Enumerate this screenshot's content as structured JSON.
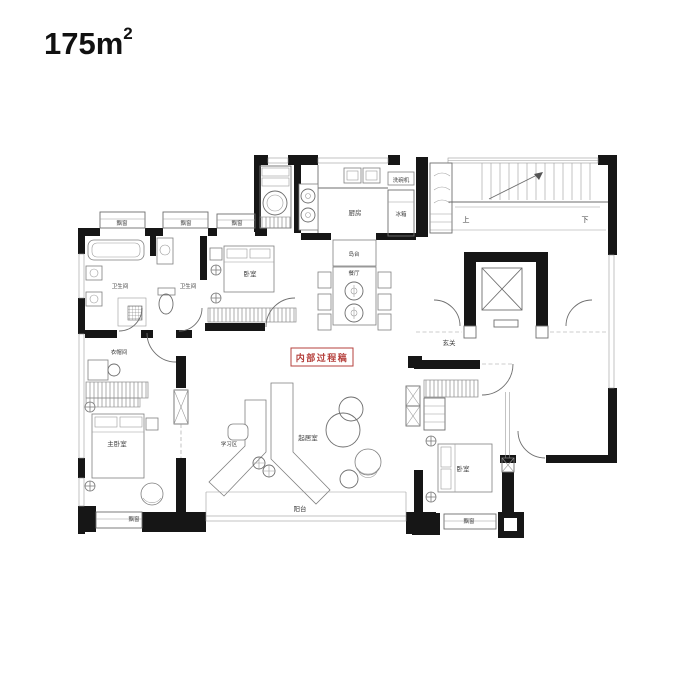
{
  "title": {
    "area": "175m",
    "sup": "2"
  },
  "watermark": {
    "text": "内部过程稿",
    "color": "#b5403c"
  },
  "rooms": {
    "kitchen": "厨房",
    "fridge": "冰箱",
    "dishwasher": "洗碗机",
    "bathroom_left": "卫生间",
    "bathroom_right": "卫生间",
    "bedroom_top": "卧室",
    "island": "岛台",
    "dining": "餐厅",
    "stairs_up": "上",
    "stairs_down": "下",
    "foyer": "玄关",
    "closet": "衣帽间",
    "master_bedroom": "主卧室",
    "study": "学习区",
    "living_room": "起居室",
    "balcony": "阳台",
    "bedroom_bottom": "卧室",
    "bay_window": "飘窗"
  },
  "colors": {
    "wall": "#161616",
    "line": "#6e6e6e",
    "label": "#3c3c3c",
    "accent": "#b5403c"
  }
}
